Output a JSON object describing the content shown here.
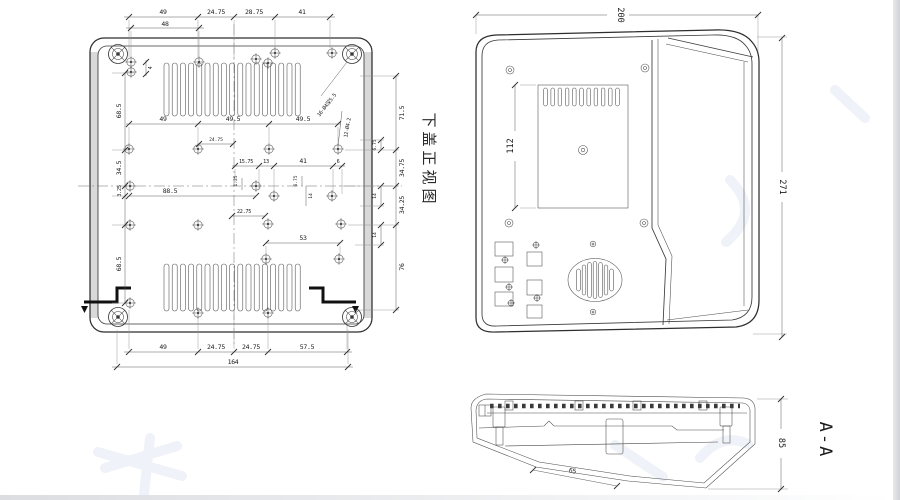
{
  "lv": {
    "title": "下盖正视图",
    "top": [
      "49",
      "24.75",
      "28.75",
      "41"
    ],
    "top2": "48",
    "left4": "4",
    "left": [
      "68.5",
      "34.5",
      "3.25",
      "68.5"
    ],
    "row1": [
      "49",
      "49.5",
      "49.5"
    ],
    "row1s": "24.75",
    "row2": [
      "15.75",
      "13",
      "41",
      "6"
    ],
    "t125": "1.25",
    "d885": "88.5",
    "d2275": "22.75",
    "i675": "6.75",
    "i14": "14",
    "d53": "53",
    "right": [
      "71.5",
      "34.75",
      "34.25",
      "76"
    ],
    "rinner": [
      "6.75",
      "14",
      "14"
    ],
    "bottom": [
      "49",
      "24.75",
      "24.75",
      "57.5"
    ],
    "total": "164",
    "callout1": "16-Ø4深5.5",
    "callout2": "12-Ø4.2"
  },
  "fv": {
    "w": "200",
    "h": "271",
    "panel": "112"
  },
  "sv": {
    "h": "85",
    "slope": "65",
    "label": "A-A"
  },
  "colors": {
    "line": "#2e2e2e",
    "paper": "#ffffff",
    "edge_bar": "#cfd1d6"
  }
}
